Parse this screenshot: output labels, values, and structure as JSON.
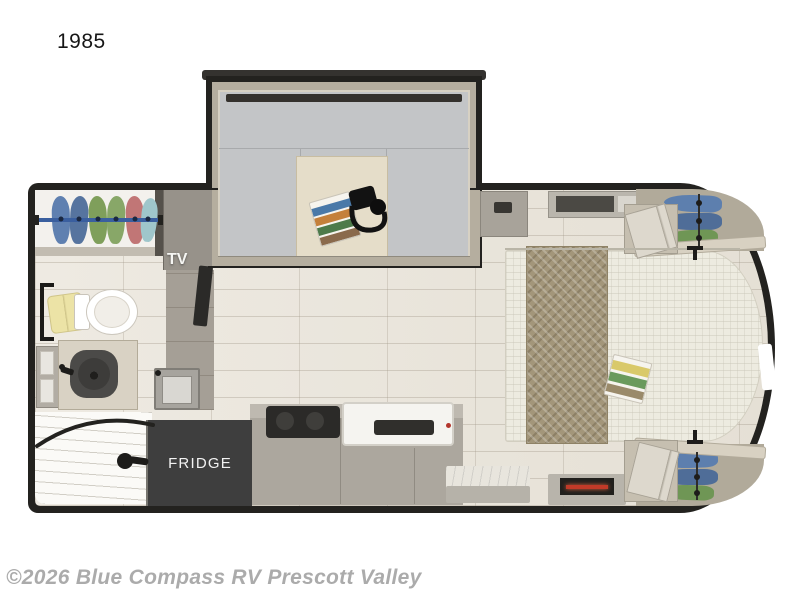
{
  "page": {
    "plan_number": "1985",
    "watermark": "©2026 Blue Compass RV Prescott Valley",
    "background": "#ffffff"
  },
  "floorplan": {
    "type": "travel-trailer-top-view",
    "labels": {
      "tv": "TV",
      "fridge": "FRIDGE"
    },
    "features": [
      "u-dinette-slideout-with-table",
      "table-items-headphones-and-magazines",
      "wardrobe-closet-with-hanging-clothes",
      "tv",
      "toilet",
      "towel",
      "bathroom-vanity-with-round-sink",
      "mirror-cabinet",
      "corner-shower-with-curved-rod",
      "fridge",
      "kitchen-sink",
      "cooktop",
      "oven",
      "entry-step-counter",
      "fireplace",
      "bed-with-runner-and-magazines",
      "front-wardrobes-with-hanging-clothes",
      "nightstands-with-open-doors",
      "overhead-vent",
      "reading-lights",
      "front-cap-window"
    ],
    "colors": {
      "wall": "#23221f",
      "floor_tile": "#ebe7df",
      "dinette_cushion": "#c3c5c7",
      "table": "#e5ddc9",
      "fridge_box": "#3e3e3e",
      "counter": "#aca79e",
      "bed": "#edebe0",
      "bed_runner": "#a3967a",
      "closet_rod": "#3a5f9f",
      "clothes_blue": "#5f80b0",
      "clothes_green": "#7f9f5b",
      "clothes_pink": "#c17676",
      "clothes_teal": "#9fc6cb",
      "towel_yellow": "#ece3a6",
      "fireplace_flame": "#c03a28"
    }
  }
}
